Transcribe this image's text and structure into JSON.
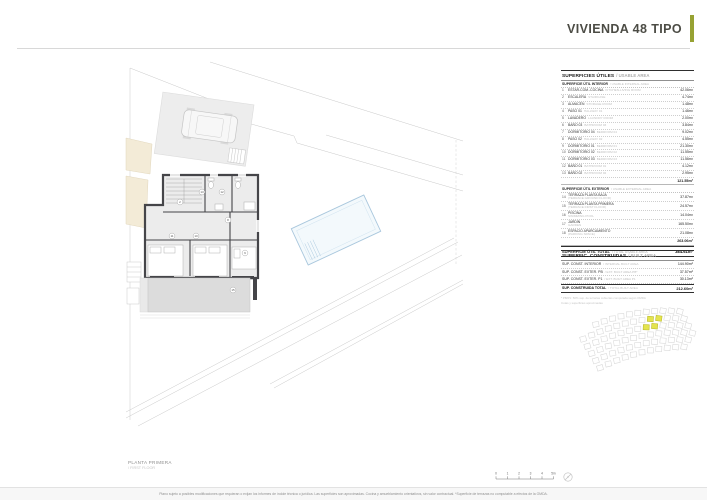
{
  "header": {
    "title": "VIVIENDA 48 TIPO",
    "accent_color": "#97a233"
  },
  "usable_table": {
    "title_es": "SUPERFICIES ÚTILES",
    "title_en": "/ USABLE AREA",
    "interior_header_es": "SUPERFICIE ÚTIL INTERIOR",
    "interior_header_en": "/ USABLE INTERNAL AREA",
    "interior_rows": [
      {
        "num": "1",
        "es": "ESTAR-COM.-COCINA",
        "en": "KITCHEN-LIVING ROOM",
        "value": "42.06m²"
      },
      {
        "num": "2",
        "es": "ESCALERA",
        "en": "STAIRCASE",
        "value": "4.74m²"
      },
      {
        "num": "3",
        "es": "ALMACÉN",
        "en": "STORAGE ROOM",
        "value": "1.48m²"
      },
      {
        "num": "4",
        "es": "PASO 01",
        "en": "HALLWAY 01",
        "value": "1.46m²"
      },
      {
        "num": "5",
        "es": "LAVADERO",
        "en": "LAUNDRY ROOM",
        "value": "2.00m²"
      },
      {
        "num": "6",
        "es": "BAÑO 03",
        "en": "BATHROOM 03",
        "value": "3.84m²"
      },
      {
        "num": "7",
        "es": "DORMITORIO 04",
        "en": "BEDROOM 04",
        "value": "9.02m²"
      },
      {
        "num": "8",
        "es": "PASO 02",
        "en": "HALLWAY 02",
        "value": "4.55m²"
      },
      {
        "num": "9",
        "es": "DORMITORIO 01",
        "en": "BEDROOM 01",
        "value": "21.30m²"
      },
      {
        "num": "10",
        "es": "DORMITORIO 02",
        "en": "BEDROOM 02",
        "value": "11.55m²"
      },
      {
        "num": "11",
        "es": "DORMITORIO 03",
        "en": "BEDROOM 03",
        "value": "11.56m²"
      },
      {
        "num": "12",
        "es": "BAÑO 01",
        "en": "BATHROOM 01",
        "value": "4.12m²"
      },
      {
        "num": "13",
        "es": "BAÑO 02",
        "en": "BATHROOM 02",
        "value": "2.95m²"
      }
    ],
    "interior_total": "121.55m²",
    "exterior_header_es": "SUPERFICIE ÚTIL EXTERIOR",
    "exterior_header_en": "/ USABLE EXTERNAL AREA",
    "exterior_rows": [
      {
        "num": "14",
        "es": "TERRAZA PLANTA BAJA",
        "en": "(TERRACE GROUND FLOOR)",
        "value": "37.87m²"
      },
      {
        "num": "15",
        "es": "TERRAZA PLANTA PRIMERA",
        "en": "(TERRACE FIRST FLOOR)",
        "value": "24.57m²"
      },
      {
        "num": "16",
        "es": "PISCINA",
        "en": "SWIMMING POOL",
        "value": "14.04m²"
      },
      {
        "num": "17",
        "es": "JARDÍN",
        "en": "GARDEN",
        "value": "165.50m²"
      },
      {
        "num": "18",
        "es": "ESPACIO APARCAMIENTO",
        "en": "(PARKING SPACE)",
        "value": "21.08m²"
      }
    ],
    "exterior_total": "263.06m²",
    "total_label_es": "SUPERFICIE ÚTIL TOTAL",
    "total_label_en": "/ TOTAL USABLE AREA",
    "total_value": "384.61m²"
  },
  "built_table": {
    "title_es": "SUPERFIC. CONSTRUIDAS",
    "title_en": "/ BUILT AREA",
    "rows": [
      {
        "es": "SUP. CONST. INTERIOR",
        "en": "/ INTERNAL BUILT AREA",
        "value": "144.90m²",
        "bold": false
      },
      {
        "es": "SUP. CONST. EXTER. PB",
        "en": "/ EXT. BUILT AREA PB*",
        "value": "37.57m²",
        "bold": false
      },
      {
        "es": "SUP. CONST. EXTER. P1",
        "en": "/ EXT. BUILT AREA P1",
        "value": "30.13m²",
        "bold": false
      },
      {
        "es": "SUP. CONSTRUIDA TOTAL",
        "en": "/ TOTAL BUILT AREA",
        "value": "212.60m²",
        "bold": true
      }
    ],
    "footnote1": "* PB/P1: 50% sup. de terrazas cubiertas computada según OMDA",
    "footnote2": "Cotas y superficies aproximadas"
  },
  "plan": {
    "caption_es": "PLANTA PRIMERA",
    "caption_en": "/ FIRST FLOOR",
    "room_numbers": [
      "13",
      "12",
      "2",
      "8",
      "11",
      "10",
      "9",
      "15"
    ],
    "pool_color": "#a9c7dd",
    "wall_color": "#454549"
  },
  "site_map": {
    "highlight_color": "#e4e44e",
    "cell_color": "#d6d6d6"
  },
  "scale_bar": {
    "labels": [
      "0",
      "1",
      "2",
      "3",
      "4",
      "5m"
    ]
  },
  "footer": {
    "text": "Plano sujeto a posibles modificaciones que requieran o exijan los informes de índole técnica o jurídica. Las superficies son aproximadas. Cocina y amueblamiento orientativos, sin valor contractual. *Superficie de terrazas no computable a efectos de la OMDA."
  }
}
